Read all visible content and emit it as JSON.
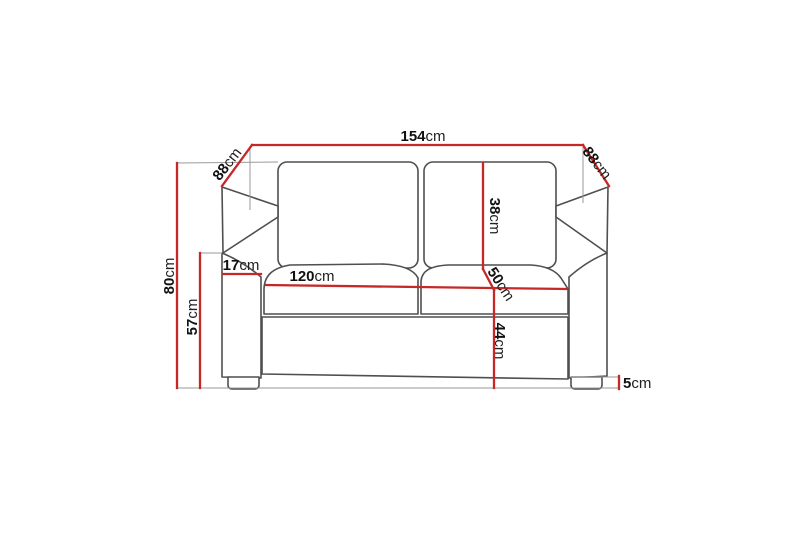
{
  "diagram": {
    "description": "Dimension drawing of a two-seat sofa, front view, with red measurement lines",
    "unit": "cm",
    "background_color": "#ffffff",
    "dimension_line_color": "#c62828",
    "sofa_outline_color": "#4f4f4f",
    "extension_line_color": "#9a9a9a",
    "text_color": "#111111",
    "dimensions": {
      "overall_width": {
        "value": "154",
        "unit": "cm",
        "label": "154cm"
      },
      "depth_left": {
        "value": "88",
        "unit": "cm",
        "label": "88cm"
      },
      "depth_right": {
        "value": "88",
        "unit": "cm",
        "label": "88cm"
      },
      "overall_height": {
        "value": "80",
        "unit": "cm",
        "label": "80cm"
      },
      "armrest_height": {
        "value": "57",
        "unit": "cm",
        "label": "57cm"
      },
      "armrest_width": {
        "value": "17",
        "unit": "cm",
        "label": "17cm"
      },
      "seat_width": {
        "value": "120",
        "unit": "cm",
        "label": "120cm"
      },
      "back_cushion_height": {
        "value": "38",
        "unit": "cm",
        "label": "38cm"
      },
      "seat_depth": {
        "value": "50",
        "unit": "cm",
        "label": "50cm"
      },
      "seat_height": {
        "value": "44",
        "unit": "cm",
        "label": "44cm"
      },
      "leg_height": {
        "value": "5",
        "unit": "cm",
        "label": "5cm"
      }
    }
  }
}
